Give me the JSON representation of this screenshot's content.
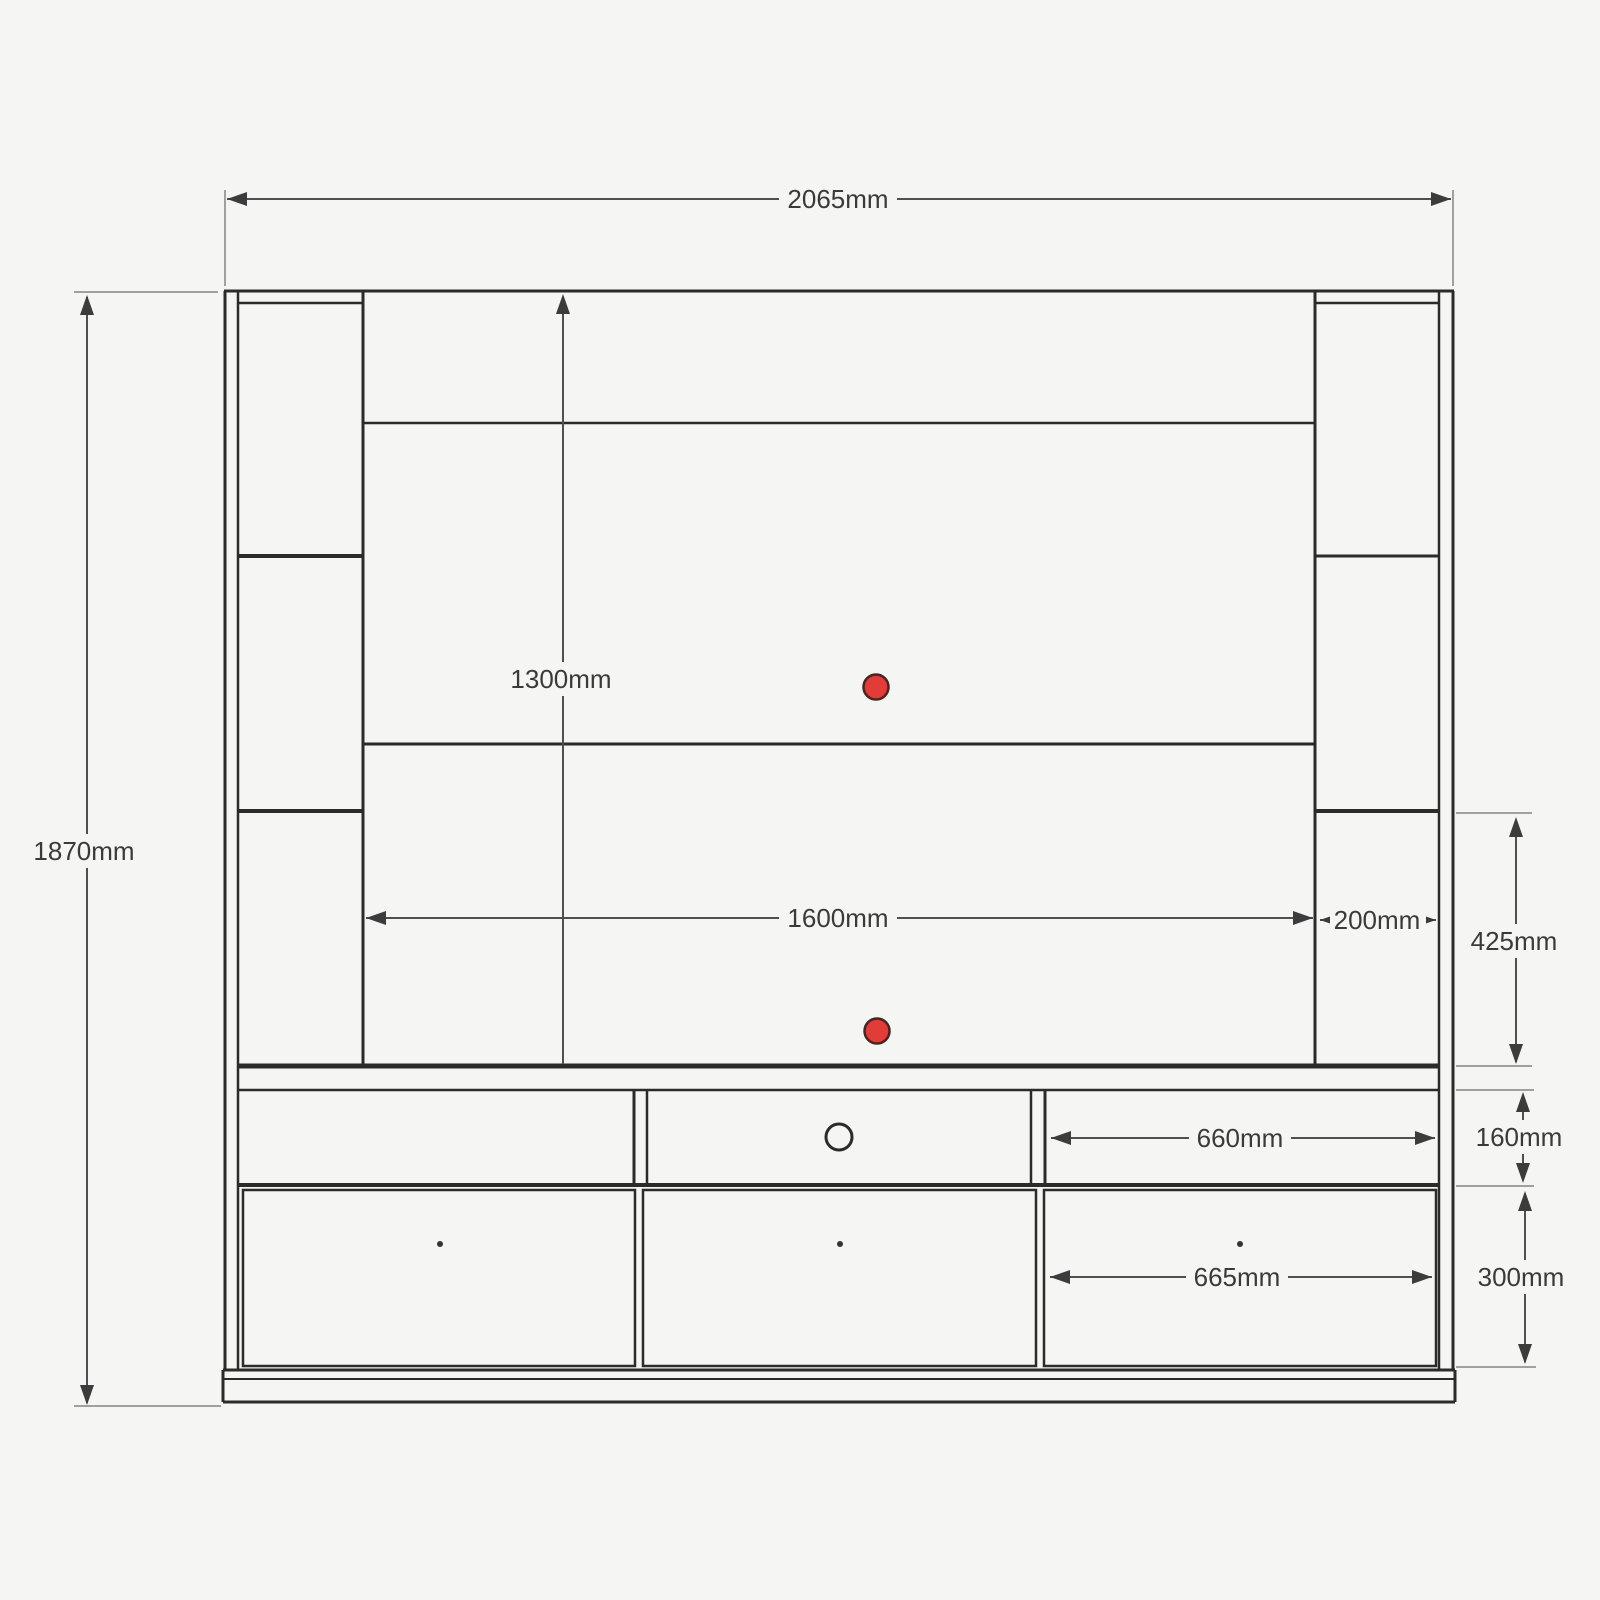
{
  "drawing": {
    "kind": "furniture-dimension-elevation",
    "units": "mm"
  },
  "dimensions": {
    "overall_width": "2065mm",
    "overall_height": "1870mm",
    "back_panel_height": "1300mm",
    "center_opening_width": "1600mm",
    "side_tower_width": "200mm",
    "side_tower_lower_height": "425mm",
    "open_shelf_width": "660mm",
    "open_shelf_height": "160mm",
    "drawer_width": "665mm",
    "drawer_height": "300mm"
  },
  "colors": {
    "background": "#f5f5f3",
    "furniture_line": "#2b2b2b",
    "dimension_line": "#4f4f4f",
    "label_text": "#3a3a3a",
    "cable_hole_red": "#e23c38"
  },
  "features": {
    "cable_holes": 2,
    "drawers": 3,
    "open_shelf_compartments": 3,
    "knob": 1
  }
}
